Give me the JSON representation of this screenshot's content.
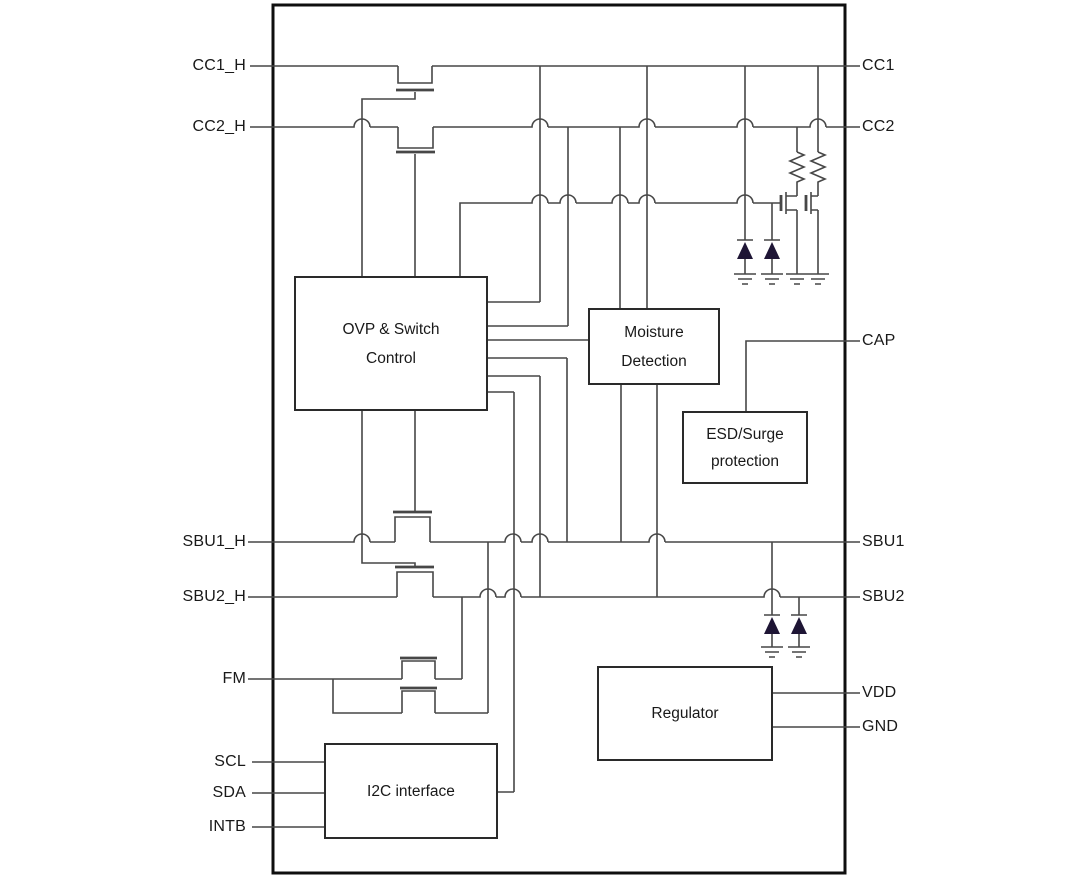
{
  "figure": {
    "type": "ic-block-diagram",
    "description": "USB port protection IC internal block diagram"
  },
  "blocks": [
    {
      "id": "ovp",
      "lines": [
        "OVP & Switch",
        "Control"
      ]
    },
    {
      "id": "moisture",
      "lines": [
        "Moisture",
        "Detection"
      ]
    },
    {
      "id": "esd",
      "lines": [
        "ESD/Surge",
        "protection"
      ]
    },
    {
      "id": "regulator",
      "lines": [
        "Regulator"
      ]
    },
    {
      "id": "i2c",
      "lines": [
        "I2C interface"
      ]
    }
  ],
  "pins_left": [
    {
      "label": "CC1_H"
    },
    {
      "label": "CC2_H"
    },
    {
      "label": "SBU1_H"
    },
    {
      "label": "SBU2_H"
    },
    {
      "label": "FM"
    },
    {
      "label": "SCL"
    },
    {
      "label": "SDA"
    },
    {
      "label": "INTB"
    }
  ],
  "pins_right": [
    {
      "label": "CC1"
    },
    {
      "label": "CC2"
    },
    {
      "label": "CAP"
    },
    {
      "label": "SBU1"
    },
    {
      "label": "SBU2"
    },
    {
      "label": "VDD"
    },
    {
      "label": "GND"
    }
  ],
  "symbols": [
    "mosfet-switch",
    "esd-diode",
    "resistor",
    "ground",
    "wire-hop"
  ],
  "colors": {
    "wire": "#474747",
    "chip_border": "#0f0f0f",
    "block_border": "#2a2a2a",
    "diode_fill": "#1e1535",
    "label": "#191919"
  }
}
